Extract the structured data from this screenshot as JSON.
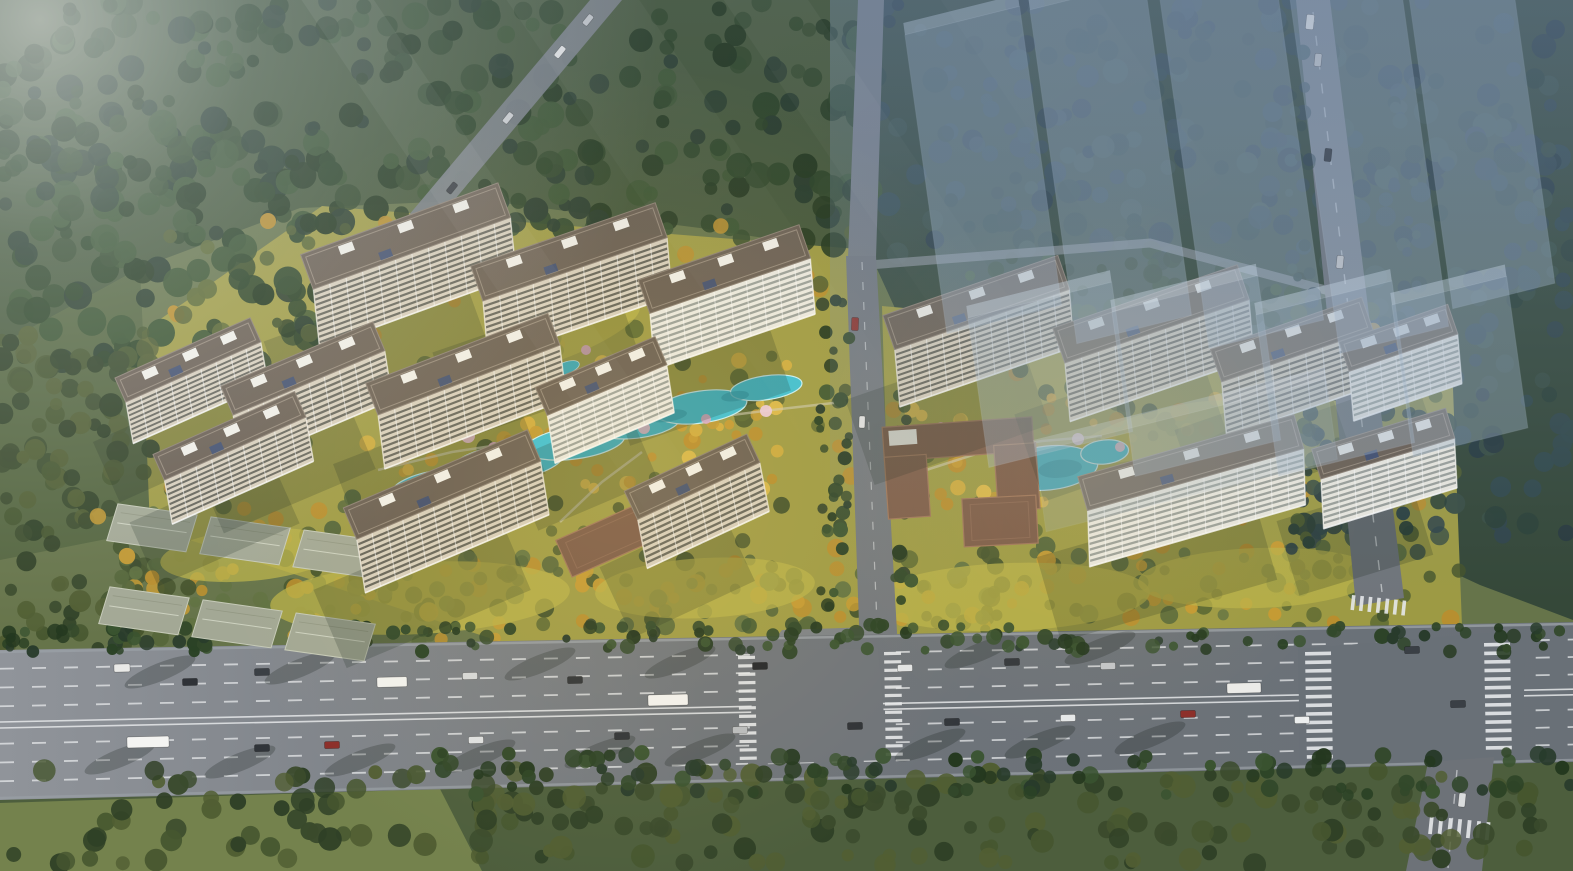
{
  "meta": {
    "width": 1573,
    "height": 871,
    "scene_description": "Aerial bird's-eye rendering of a two-cluster residential development with cream slab towers, dark roofs, landscaped courtyards with turquoise pools and golden autumn trees, translucent future-phase building massing over forest at top right, forest belts, low-rise rows at lower left, and a wide multi-lane arterial road with two signalized junctions along the bottom."
  },
  "palette": {
    "base": "#66744a",
    "road_light": "#90949a",
    "road_mid": "#6f747a",
    "road_dark": "#697077",
    "road_edge": "#9aa0a6",
    "marking": "#e6e8ea",
    "apron": "#7d8287",
    "facade": "#d8cfbd",
    "window": "#54544c",
    "white_facade": "#ebe9e0",
    "white_window": "#8f958f",
    "roof": "#6b6054",
    "roof_edge": "#8d8174",
    "roof_unit": "#f1efe8",
    "pv_panel": "#3f4f72",
    "clubhouse": "#7c5b48",
    "clubhouse_edge": "#a0765a",
    "lowrise": "#a3a895",
    "lowrise_edge": "#c6cab8",
    "ghost_fill": "#a6b9cc",
    "ghost_top": "#cfdce8",
    "ghost_edge": "#cddced",
    "pool": "#3fc0d4",
    "pool_deep": "#2b9fb5",
    "pool_rim": "#c8f0f6",
    "lawn_bright": "#b9b24a",
    "path": "#cfc9b2",
    "shadow": "#16231a",
    "tree_shadow": "rgba(22,32,26,0.25)"
  },
  "terrain": {
    "zones": [
      {
        "name": "north-forest",
        "points": "0,0 872,0 872,255 700,228 480,200 300,208 140,268 0,345",
        "fill": "#47593b"
      },
      {
        "name": "west-forest-strip",
        "points": "0,345 140,268 152,530 0,560",
        "fill": "#54653f"
      },
      {
        "name": "northeast-forest",
        "points": "872,0 1573,0 1573,620 1480,585 1340,520 1180,458 1010,393 905,330 872,258",
        "fill": "#354839"
      },
      {
        "name": "south-green-belt",
        "points": "0,795 1573,757 1573,871 0,871",
        "fill": "#4d5e3d"
      },
      {
        "name": "southwest-meadow",
        "points": "0,803 440,789 482,871 0,871",
        "fill": "#74824d"
      },
      {
        "name": "site-lawn-west",
        "points": "142,332 322,206 870,250 882,650 520,648 150,527",
        "fill": "#9f9b45"
      },
      {
        "name": "site-lawn-east",
        "points": "882,306 1060,322 1360,346 1452,362 1462,626 892,648",
        "fill": "#9d9a44"
      }
    ]
  },
  "tree_palettes": {
    "dark": [
      "#24381f",
      "#2b4225",
      "#32482a",
      "#3a5330",
      "#283b2b"
    ],
    "darkOlive": [
      "#3a4a2c",
      "#46562f",
      "#2f4026",
      "#515e33"
    ],
    "cool": [
      "#2c4138",
      "#33494b",
      "#283a3f",
      "#3a4f44",
      "#31454a"
    ],
    "site": [
      "#45542c",
      "#515f31",
      "#5c6933",
      "#b98e2e"
    ],
    "gold": [
      "#c59a33",
      "#d3ad3f",
      "#b98e2e",
      "#dcb94a"
    ],
    "goldmix": [
      "#c59a33",
      "#55663a",
      "#617242",
      "#b98e2e",
      "#46552d"
    ]
  },
  "tree_regions": [
    [
      0,
      0,
      872,
      245,
      290,
      "dark",
      6,
      14,
      0
    ],
    [
      0,
      110,
      340,
      270,
      120,
      "dark",
      7,
      15,
      0
    ],
    [
      0,
      330,
      152,
      330,
      105,
      "darkOlive",
      6,
      12,
      0
    ],
    [
      865,
      0,
      708,
      255,
      235,
      "cool",
      6,
      13,
      0
    ],
    [
      1295,
      250,
      278,
      300,
      115,
      "cool",
      6,
      12,
      0
    ],
    [
      955,
      248,
      345,
      92,
      60,
      "dark",
      5,
      10,
      0
    ],
    [
      170,
      215,
      700,
      420,
      165,
      "site",
      5,
      10,
      0
    ],
    [
      885,
      310,
      575,
      320,
      110,
      "site",
      5,
      10,
      0
    ],
    [
      95,
      470,
      420,
      175,
      80,
      "goldmix",
      5,
      9,
      0
    ],
    [
      360,
      360,
      440,
      130,
      70,
      "gold",
      4,
      8,
      0
    ],
    [
      905,
      395,
      340,
      110,
      45,
      "gold",
      4,
      8,
      0
    ],
    [
      150,
      555,
      720,
      75,
      85,
      "goldmix",
      5,
      10,
      0
    ],
    [
      890,
      545,
      520,
      75,
      70,
      "goldmix",
      5,
      10,
      0
    ],
    [
      0,
      624,
      1573,
      28,
      150,
      "dark",
      4,
      8,
      1
    ],
    [
      0,
      770,
      1573,
      95,
      220,
      "darkOlive",
      6,
      12,
      1
    ],
    [
      430,
      752,
      1143,
      44,
      100,
      "dark",
      5,
      9,
      1
    ],
    [
      814,
      300,
      36,
      330,
      34,
      "dark",
      4,
      8,
      1
    ],
    [
      894,
      312,
      30,
      318,
      28,
      "dark",
      4,
      8,
      1
    ],
    [
      1288,
      40,
      26,
      510,
      40,
      "cool",
      4,
      8,
      1
    ],
    [
      1394,
      70,
      26,
      490,
      34,
      "cool",
      4,
      8,
      1
    ]
  ],
  "garden": {
    "lawn_patches": [
      [
        420,
        598,
        150,
        36,
        -3
      ],
      [
        705,
        588,
        110,
        30,
        -3
      ],
      [
        1010,
        597,
        140,
        34,
        -2
      ],
      [
        1258,
        578,
        120,
        30,
        -2
      ],
      [
        545,
        338,
        100,
        26,
        -19
      ],
      [
        1160,
        432,
        90,
        22,
        -15
      ],
      [
        250,
        555,
        90,
        26,
        -5
      ]
    ],
    "paths": [
      "378,470 452,452 532,440 612,430 692,420 772,410 842,402",
      "560,522 602,482 642,452",
      "920,472 982,452 1042,441 1102,436"
    ],
    "pool_left": {
      "x": 610,
      "y": 440,
      "a": -8,
      "ellipses": [
        [
          -175,
          22,
          48,
          16
        ],
        [
          -105,
          8,
          56,
          18
        ],
        [
          -35,
          -2,
          50,
          16
        ],
        [
          30,
          -12,
          42,
          14
        ],
        [
          95,
          -20,
          46,
          16
        ],
        [
          162,
          -30,
          36,
          12
        ]
      ],
      "deep": [
        [
          -140,
          15,
          22,
          7
        ],
        [
          60,
          -16,
          20,
          6
        ],
        [
          130,
          -26,
          14,
          5
        ]
      ]
    },
    "pool_right": {
      "x": 1048,
      "y": 468,
      "a": -6,
      "ellipses": [
        [
          0,
          0,
          50,
          22
        ],
        [
          58,
          -10,
          24,
          12
        ]
      ],
      "deep": [
        [
          12,
          2,
          22,
          9
        ]
      ]
    },
    "ponds": [
      [
        512,
        356,
        16,
        7,
        -20
      ],
      [
        566,
        368,
        14,
        6,
        -20
      ]
    ],
    "blossoms": [
      [
        468,
        436,
        7
      ],
      [
        494,
        448,
        6
      ],
      [
        522,
        441,
        5
      ],
      [
        644,
        428,
        6
      ],
      [
        706,
        419,
        5
      ],
      [
        766,
        411,
        6
      ],
      [
        906,
        431,
        6
      ],
      [
        941,
        427,
        5
      ],
      [
        1078,
        439,
        6
      ],
      [
        1120,
        447,
        5
      ],
      [
        586,
        350,
        5
      ]
    ],
    "blossom_colors": [
      "#e9bcd3",
      "#d9a6c4",
      "#f0cde0"
    ]
  },
  "roads": {
    "main_points": "0,650 1573,622 1573,762 0,800",
    "main_top": [
      650,
      622
    ],
    "main_bottom": [
      800,
      762
    ],
    "lane_fractions": [
      0.125,
      0.25,
      0.375,
      0.625,
      0.75,
      0.875
    ],
    "median_fractions": [
      0.48,
      0.52
    ],
    "intersection_points": "1298,649 1526,630 1522,760 1300,764",
    "access_junction_points": "755,651 878,648 888,760 748,764",
    "access_points": "846,256 876,256 898,650 860,652",
    "access_top_points": "858,0 884,0 876,258 848,258",
    "access_apron_points": "765,652 782,630 872,627 892,650",
    "cross_north_points": "1296,0 1330,0 1404,598 1356,606",
    "cross_south_points": "1428,762 1494,757 1482,871 1406,871",
    "forest_road_points": "590,0 622,0 404,260 376,254",
    "right_top_road": "856,266 1150,243 1348,296",
    "cross_north_line": [
      1313,
      12,
      1382,
      592
    ],
    "cross_south_line": [
      1457,
      770,
      1448,
      868
    ],
    "access_line": [
      862,
      262,
      878,
      648
    ]
  },
  "crosswalks": [
    {
      "x": 1305,
      "y": 652,
      "n": 13,
      "s": 8.6,
      "bw": 26,
      "bh": 3.6,
      "r": -1,
      "h": false
    },
    {
      "x": 1484,
      "y": 643,
      "n": 13,
      "s": 8.6,
      "bw": 26,
      "bh": 3.6,
      "r": -1,
      "h": false
    },
    {
      "x": 1352,
      "y": 595,
      "n": 7,
      "s": 8.5,
      "bw": 3.6,
      "bh": 15,
      "r": 6,
      "h": true
    },
    {
      "x": 1430,
      "y": 816,
      "n": 7,
      "s": 9.5,
      "bw": 3.8,
      "bh": 18,
      "r": 6,
      "h": true
    },
    {
      "x": 738,
      "y": 656,
      "n": 13,
      "s": 8.4,
      "bw": 17,
      "bh": 3.2,
      "r": -1,
      "h": false
    },
    {
      "x": 884,
      "y": 652,
      "n": 13,
      "s": 8.4,
      "bw": 17,
      "bh": 3.2,
      "r": -1,
      "h": false
    }
  ],
  "tree_shadows_on_road": [
    [
      120,
      758
    ],
    [
      240,
      762
    ],
    [
      360,
      760
    ],
    [
      480,
      756
    ],
    [
      600,
      752
    ],
    [
      700,
      750
    ],
    [
      930,
      745
    ],
    [
      1040,
      742
    ],
    [
      1150,
      738
    ],
    [
      680,
      662
    ],
    [
      540,
      664
    ],
    [
      300,
      668
    ],
    [
      160,
      672
    ],
    [
      980,
      652
    ],
    [
      1100,
      648
    ]
  ],
  "low_rise": {
    "rows": [
      {
        "x": 112,
        "y": 503,
        "a": 8
      },
      {
        "x": 104,
        "y": 586,
        "a": 8
      }
    ],
    "unit_w": 86,
    "unit_h": 38,
    "gap": 8,
    "per_row": 3
  },
  "towers": [
    {
      "x": 415,
      "y": 262,
      "len": 210,
      "wid": 92,
      "a": -20,
      "t": "cream"
    },
    {
      "x": 578,
      "y": 278,
      "len": 195,
      "wid": 92,
      "a": -19,
      "t": "cream"
    },
    {
      "x": 733,
      "y": 294,
      "len": 170,
      "wid": 88,
      "a": -19,
      "t": "white"
    },
    {
      "x": 196,
      "y": 378,
      "len": 148,
      "wid": 66,
      "a": -24,
      "t": "cream"
    },
    {
      "x": 312,
      "y": 390,
      "len": 165,
      "wid": 78,
      "a": -23,
      "t": "cream"
    },
    {
      "x": 472,
      "y": 388,
      "len": 195,
      "wid": 85,
      "a": -21,
      "t": "cream"
    },
    {
      "x": 610,
      "y": 397,
      "len": 130,
      "wid": 76,
      "a": -23,
      "t": "white"
    },
    {
      "x": 238,
      "y": 455,
      "len": 155,
      "wid": 70,
      "a": -24,
      "t": "cream"
    },
    {
      "x": 452,
      "y": 508,
      "len": 200,
      "wid": 85,
      "a": -23,
      "t": "cream"
    },
    {
      "x": 702,
      "y": 498,
      "len": 135,
      "wid": 78,
      "a": -25,
      "t": "cream"
    },
    {
      "x": 985,
      "y": 328,
      "len": 185,
      "wid": 90,
      "a": -19,
      "t": "cream"
    },
    {
      "x": 1160,
      "y": 340,
      "len": 195,
      "wid": 92,
      "a": -19,
      "t": "cream"
    },
    {
      "x": 1300,
      "y": 364,
      "len": 160,
      "wid": 86,
      "a": -19,
      "t": "cream"
    },
    {
      "x": 1406,
      "y": 360,
      "len": 115,
      "wid": 78,
      "a": -19,
      "t": "white"
    },
    {
      "x": 1198,
      "y": 488,
      "len": 225,
      "wid": 88,
      "a": -16,
      "t": "white"
    },
    {
      "x": 1390,
      "y": 466,
      "len": 140,
      "wid": 78,
      "a": -17,
      "t": "white"
    }
  ],
  "clubhouses": {
    "left": {
      "cx": 472,
      "cy": 378,
      "w": 128,
      "h": 56,
      "a": -22
    },
    "right": {
      "cx": 960,
      "cy": 466,
      "a": -4,
      "parts": [
        [
          -75,
          -44,
          150,
          34
        ],
        [
          -75,
          -14,
          42,
          62
        ],
        [
          35,
          -18,
          42,
          66
        ]
      ],
      "panel": [
        -69,
        -40,
        28,
        15
      ]
    }
  },
  "gates": [
    {
      "cx": 606,
      "cy": 540,
      "w": 92,
      "h": 40,
      "a": -24
    },
    {
      "cx": 1000,
      "cy": 521,
      "w": 74,
      "h": 48,
      "a": -3
    }
  ],
  "ghost_blocks": [
    [
      905,
      35,
      118,
      300,
      0.4
    ],
    [
      1030,
      10,
      118,
      335,
      0.4
    ],
    [
      1158,
      -15,
      118,
      365,
      0.4
    ],
    [
      1286,
      -30,
      112,
      385,
      0.4
    ],
    [
      1406,
      -25,
      105,
      335,
      0.4
    ],
    [
      968,
      318,
      148,
      150,
      0.38
    ],
    [
      1112,
      312,
      150,
      165,
      0.38
    ],
    [
      1256,
      315,
      140,
      162,
      0.38
    ],
    [
      1392,
      305,
      118,
      152,
      0.38
    ],
    [
      1035,
      452,
      300,
      80,
      0.22
    ]
  ],
  "vehicles": {
    "main_road": [
      [
        122,
        668,
        16,
        8,
        "#e9e9e7"
      ],
      [
        190,
        682,
        15,
        7,
        "#2f3237"
      ],
      [
        262,
        672,
        15,
        7,
        "#3a3f45"
      ],
      [
        392,
        682,
        30,
        10,
        "#f2f2ef"
      ],
      [
        470,
        676,
        15,
        7,
        "#d6d8da"
      ],
      [
        575,
        680,
        15,
        7,
        "#2f3338"
      ],
      [
        668,
        700,
        40,
        11,
        "#f2f2f0"
      ],
      [
        760,
        666,
        15,
        7,
        "#23262b"
      ],
      [
        905,
        668,
        15,
        7,
        "#e2e4e6"
      ],
      [
        1012,
        662,
        15,
        7,
        "#34383d"
      ],
      [
        1108,
        666,
        15,
        7,
        "#c3c6c9"
      ],
      [
        1244,
        688,
        34,
        10,
        "#ebebe8"
      ],
      [
        1412,
        650,
        15,
        7,
        "#3a3f45"
      ],
      [
        148,
        742,
        42,
        11,
        "#f4f4f2"
      ],
      [
        262,
        748,
        15,
        7,
        "#303439"
      ],
      [
        332,
        745,
        15,
        7,
        "#8c2f2a"
      ],
      [
        476,
        740,
        15,
        7,
        "#dfe1e3"
      ],
      [
        622,
        736,
        15,
        7,
        "#2f3338"
      ],
      [
        740,
        730,
        15,
        7,
        "#b9bcbf"
      ],
      [
        855,
        726,
        15,
        7,
        "#2e3237"
      ],
      [
        952,
        722,
        15,
        7,
        "#33373c"
      ],
      [
        1068,
        718,
        15,
        7,
        "#e6e8e9"
      ],
      [
        1188,
        714,
        15,
        7,
        "#8c2f2a"
      ],
      [
        1302,
        720,
        15,
        7,
        "#eceeee"
      ],
      [
        1458,
        704,
        15,
        7,
        "#3a3f45"
      ]
    ],
    "main_road_angle": -1.4,
    "other": [
      [
        1310,
        22,
        15,
        8,
        "#f0f0ee",
        96
      ],
      [
        1318,
        60,
        13,
        7,
        "#caccce",
        96
      ],
      [
        1328,
        155,
        13,
        7,
        "#34383d",
        96
      ],
      [
        1340,
        262,
        13,
        7,
        "#c3c6c9",
        96
      ],
      [
        1462,
        800,
        14,
        7,
        "#dadcdd",
        96
      ],
      [
        855,
        324,
        13,
        7,
        "#8c2f2a",
        92
      ],
      [
        862,
        422,
        12,
        6,
        "#e8e8e8",
        92
      ],
      [
        588,
        20,
        12,
        6,
        "#c8cacc",
        -51
      ],
      [
        560,
        52,
        13,
        6,
        "#eaeae8",
        -51
      ],
      [
        508,
        118,
        12,
        6,
        "#d0d2d4",
        -51
      ],
      [
        452,
        188,
        12,
        6,
        "#34383d",
        -51
      ]
    ]
  },
  "effects": {
    "haze_rect": [
      830,
      0,
      743,
      600
    ],
    "haze_color": "125,150,185",
    "haze_alpha": 0.38,
    "cool_top_rect": [
      0,
      0,
      1573,
      300
    ],
    "cool_color": "95,115,145",
    "cool_alpha": 0.18,
    "glare_center": [
      40,
      20
    ],
    "glare_radius": 620,
    "rays": [
      [
        250,
        60,
        0.1
      ],
      [
        420,
        110,
        0.07
      ],
      [
        600,
        70,
        0.1
      ],
      [
        780,
        130,
        0.06
      ]
    ],
    "ray_angle": -34,
    "warm_spots": [
      [
        620,
        480,
        420,
        190,
        0.14
      ],
      [
        1090,
        470,
        280,
        150,
        0.1
      ]
    ]
  }
}
